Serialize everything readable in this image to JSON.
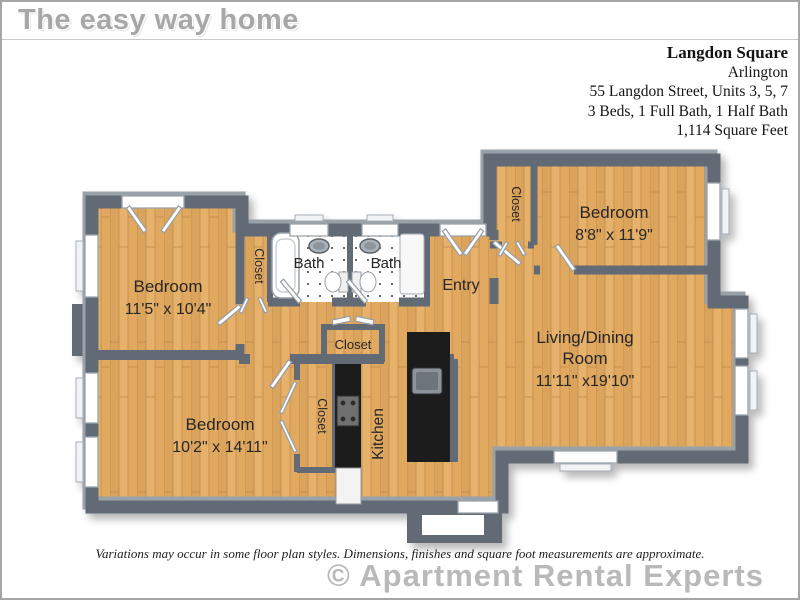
{
  "header": {
    "brand": "The easy way home"
  },
  "property": {
    "name": "Langdon Square",
    "city": "Arlington",
    "address": "55 Langdon Street, Units 3, 5, 7",
    "beds_baths": "3 Beds, 1 Full Bath, 1 Half Bath",
    "area": "1,114 Square Feet"
  },
  "floorplan": {
    "labels": {
      "bedroom": "Bedroom",
      "bath": "Bath",
      "entry": "Entry",
      "closet": "Closet",
      "kitchen": "Kitchen",
      "living_line1": "Living/Dining",
      "living_line2": "Room"
    },
    "dims": {
      "bed1": "11'5\" x 10'4\"",
      "bed2": "8'8\" x 11'9\"",
      "bed3": "10'2\" x 14'11\"",
      "living": "11'11\" x19'10\""
    },
    "colors": {
      "wall": "#626b75",
      "wall_top": "#99a1a9",
      "floor_wood": "#e2ab63",
      "counter": "#1b1b1b",
      "tile_dot": "#3a3a3a"
    }
  },
  "footer": {
    "disclaimer": "Variations may occur in some floor plan styles. Dimensions, finishes and square foot measurements are approximate.",
    "watermark": "© Apartment Rental Experts"
  }
}
